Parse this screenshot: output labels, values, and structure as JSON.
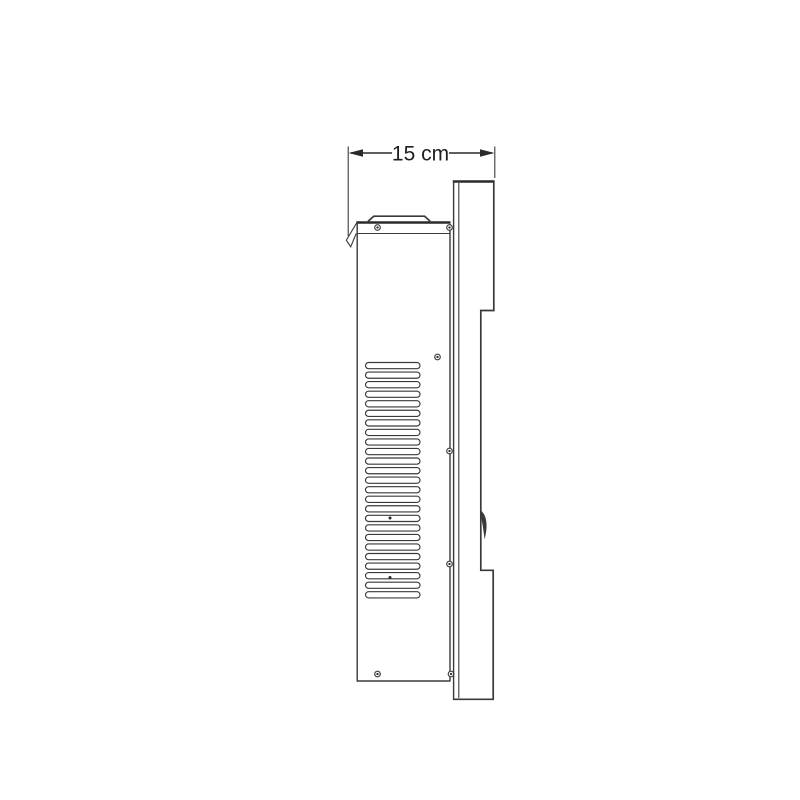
{
  "page": {
    "background": "#ffffff",
    "description": "Technical side-view line drawing of a wall-mounted appliance with a width dimension annotation"
  },
  "drawing": {
    "line_color": "#3a3a3a",
    "line_color_dark": "#2a2a2a",
    "text_color": "#1f1f1f",
    "dimension": {
      "label": "15 cm"
    },
    "vents": {
      "count": 25,
      "x": 365.5,
      "top": 362.5,
      "pitch": 9.55,
      "width": 54.5,
      "height": 6.2
    },
    "screws": [
      {
        "x": 377.5,
        "y": 227.5
      },
      {
        "x": 449.5,
        "y": 227.5
      },
      {
        "x": 437.5,
        "y": 357.0
      },
      {
        "x": 449.5,
        "y": 451.0
      },
      {
        "x": 449.5,
        "y": 564.0
      },
      {
        "x": 377.5,
        "y": 674.0
      },
      {
        "x": 451.0,
        "y": 674.0
      }
    ],
    "rivets": [
      {
        "x": 390.0,
        "y": 518.0
      },
      {
        "x": 390.0,
        "y": 577.5
      }
    ]
  }
}
